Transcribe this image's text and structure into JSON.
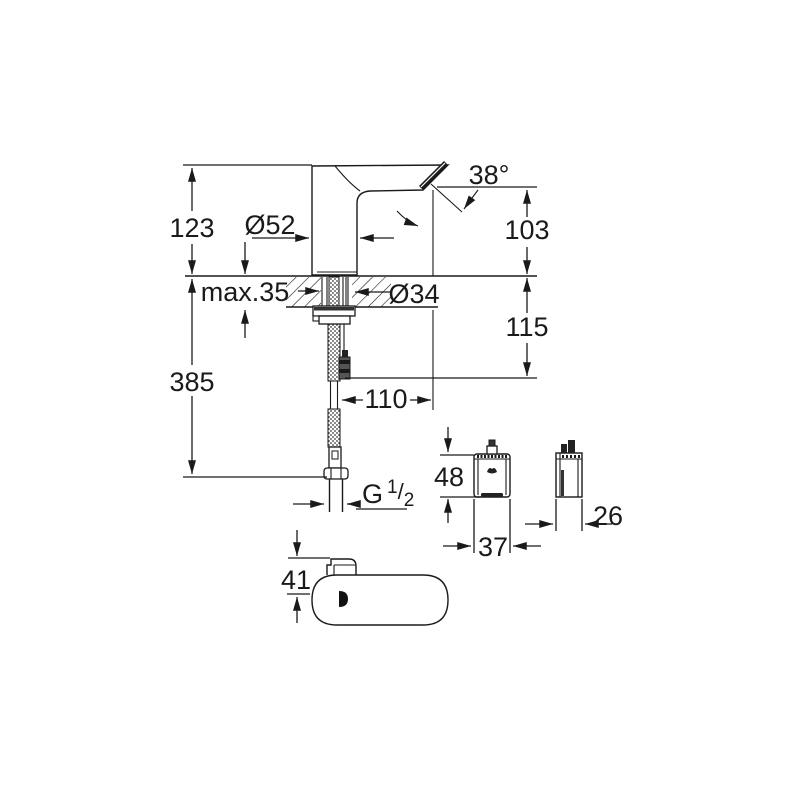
{
  "drawing": {
    "dims": {
      "height_above_deck": "123",
      "base_diameter": "Ø52",
      "spout_angle": "38°",
      "outlet_height": "103",
      "max_deck_thickness": "max.35",
      "hole_diameter": "Ø34",
      "below_deck_height": "115",
      "total_below_deck": "385",
      "spout_projection": "110",
      "box_height": "48",
      "box_width": "37",
      "box_depth": "26",
      "top_view_width": "41",
      "thread": {
        "prefix": "G",
        "numerator": "1",
        "slash": "/",
        "denominator": "2"
      }
    },
    "colors": {
      "line": "#1a1a1a",
      "background": "#ffffff"
    }
  }
}
